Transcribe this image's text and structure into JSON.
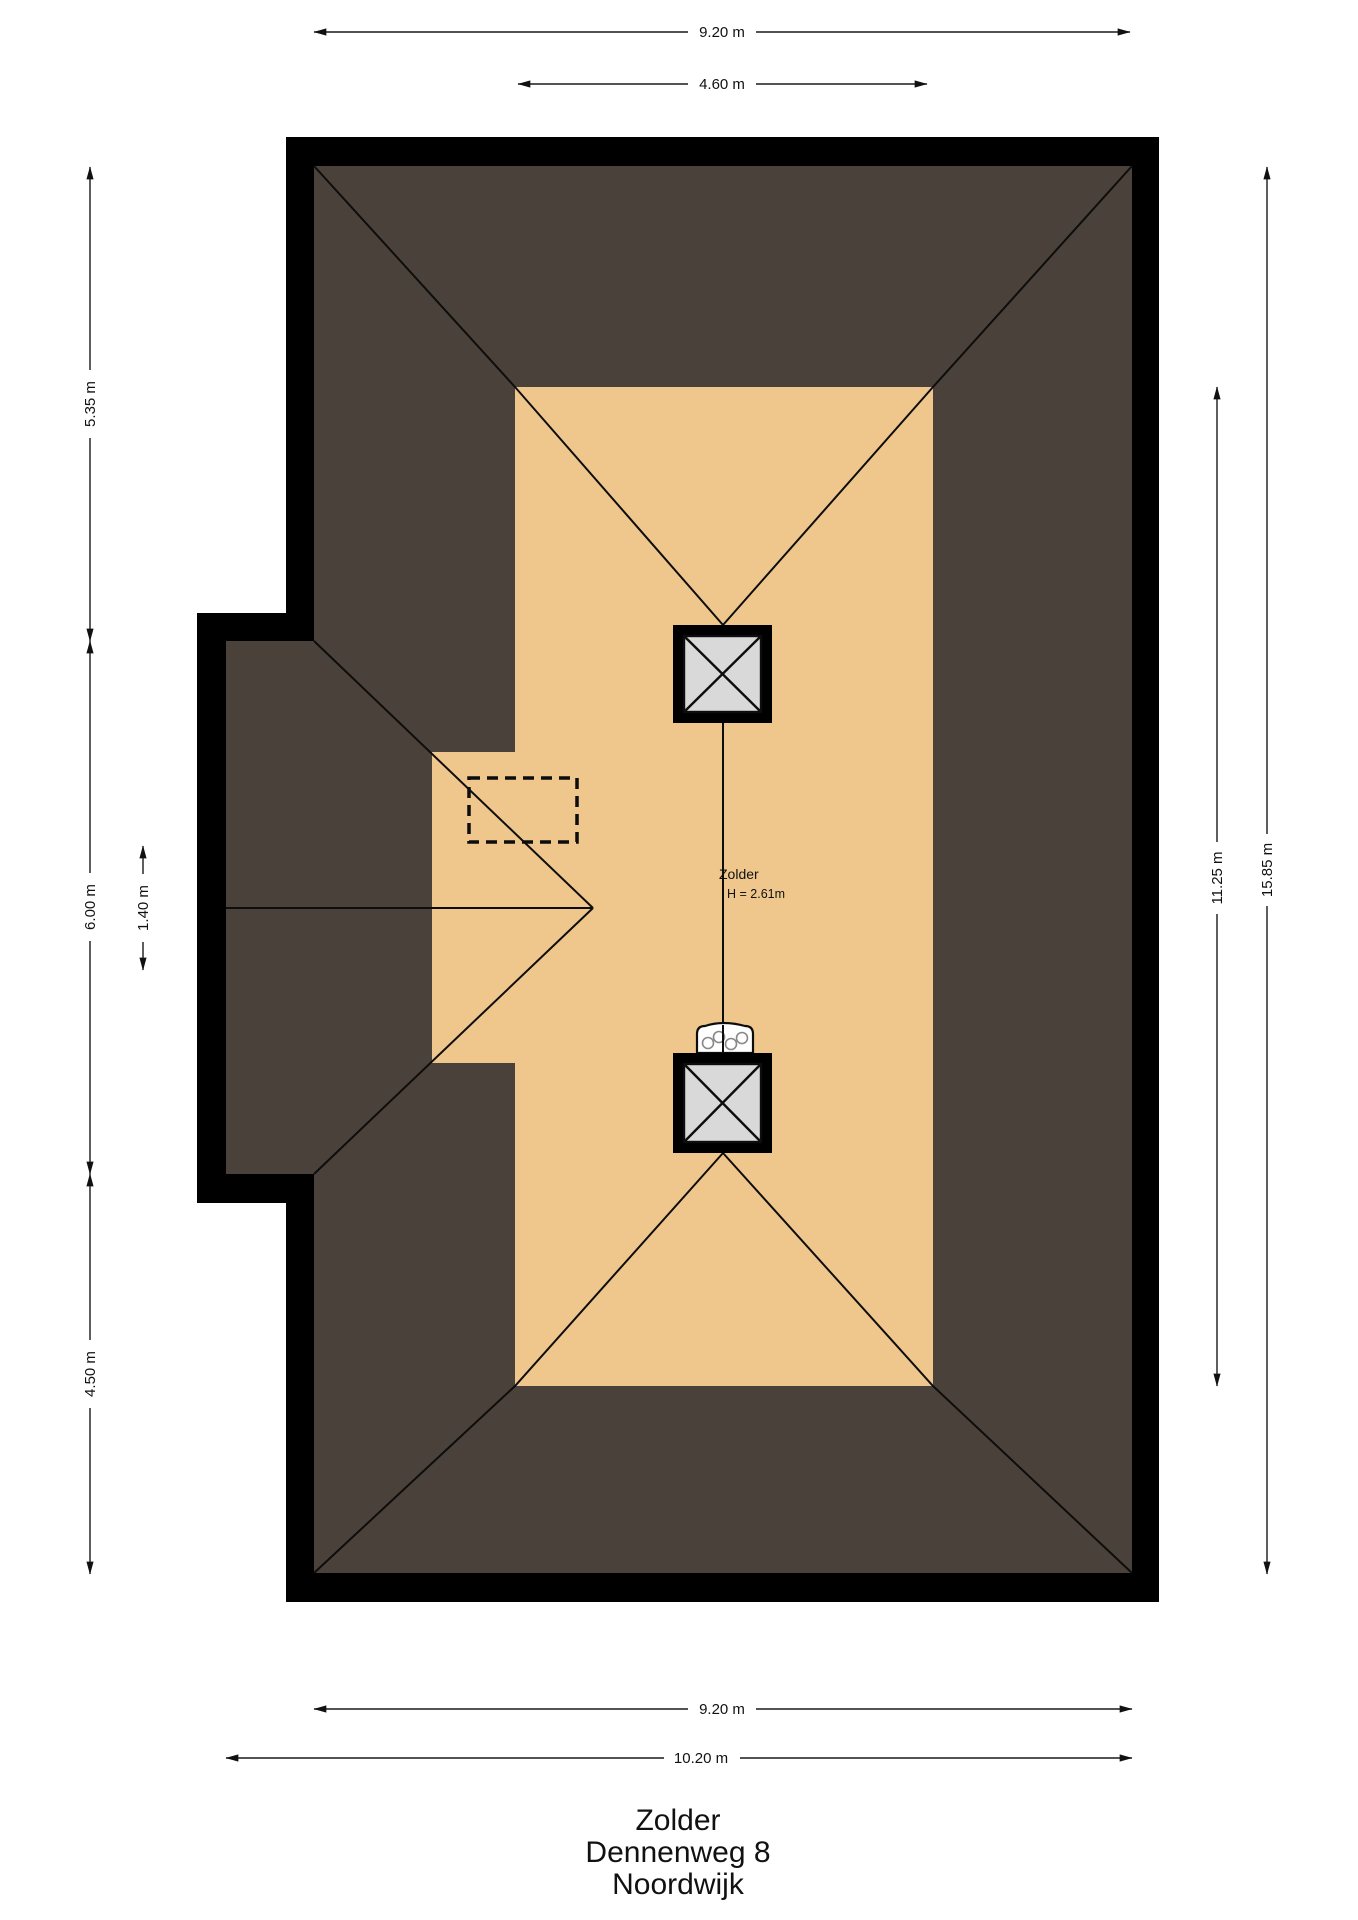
{
  "plan": {
    "room": {
      "name": "Zolder",
      "height_note": "H = 2.61m"
    },
    "title": {
      "line1": "Zolder",
      "line2": "Dennenweg 8",
      "line3": "Noordwijk"
    },
    "dims": {
      "top_outer": "9.20 m",
      "top_inner": "4.60 m",
      "left_top": "5.35 m",
      "left_mid": "6.00 m",
      "left_small": "1.40 m",
      "left_bottom": "4.50 m",
      "right_inner": "11.25 m",
      "right_outer": "15.85 m",
      "bottom_inner": "9.20 m",
      "bottom_outer": "10.20 m"
    },
    "colors": {
      "wall": "#000000",
      "roof": "#4a423a",
      "floor": "#efc78d",
      "skylight_glass": "#d9d9d9",
      "white": "#ffffff"
    }
  }
}
